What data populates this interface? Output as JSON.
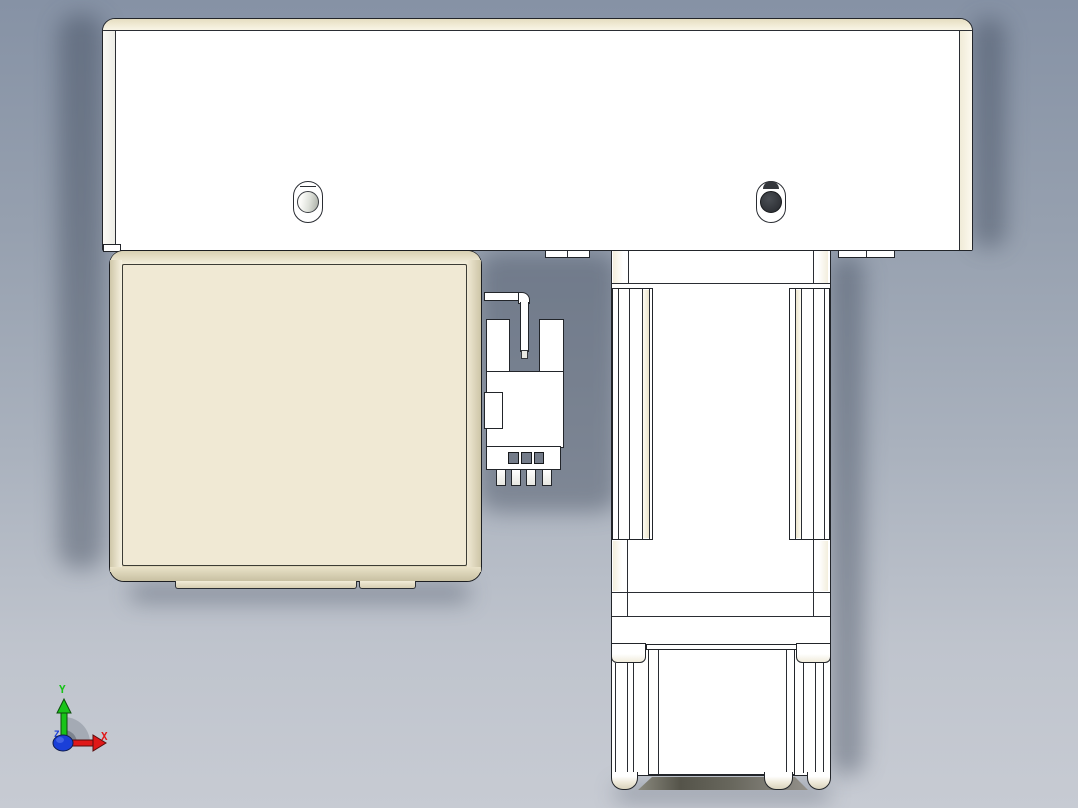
{
  "viewport": {
    "type": "cad-orthographic-view",
    "background_top": "#8692a5",
    "background_bottom": "#c7cbd3"
  },
  "model": {
    "part_colors": {
      "face_white": "#ffffff",
      "face_cream": "#f0e9d4",
      "bevel_cream_light": "#f6f1e0",
      "bevel_cream_dark": "#cdc5a7",
      "outline": "#22252a",
      "screw_dark": "#34373c",
      "screw_light": "#c9cdc5",
      "underside_dark": "#55544a"
    }
  },
  "axis_triad": {
    "x_label": "X",
    "y_label": "Y",
    "z_label": "Z",
    "x_color": "#e01818",
    "y_color": "#18c418",
    "z_color": "#1a3fd8",
    "arc_color": "#8d93a0"
  }
}
